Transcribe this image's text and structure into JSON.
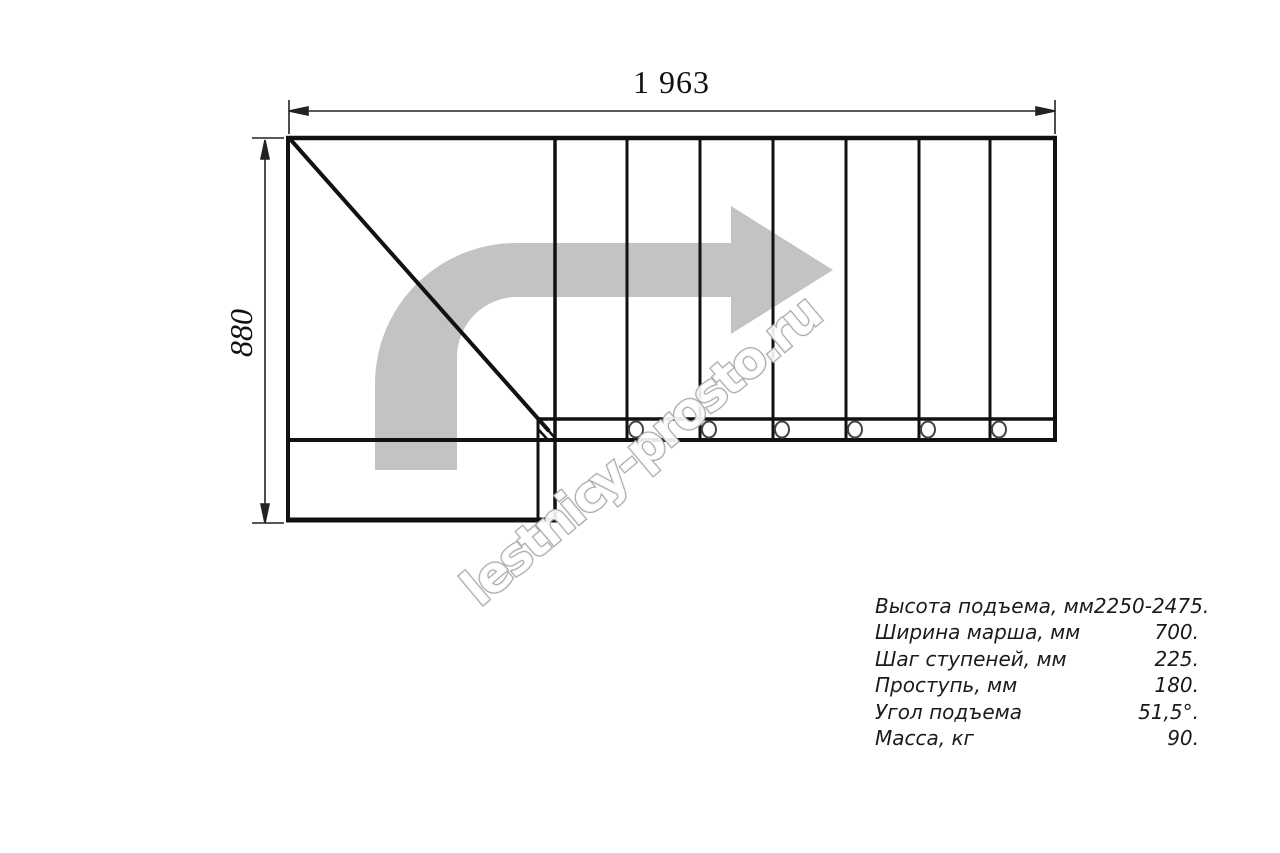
{
  "watermark": {
    "text": "lestnicy-prosto.ru"
  },
  "dimensions": {
    "width_label": "1 963",
    "height_label": "880"
  },
  "plan": {
    "step_lines_x": [
      627,
      700,
      773,
      846,
      919,
      990
    ],
    "bolt_circles_x": [
      636,
      709,
      782,
      855,
      928,
      999
    ],
    "colors": {
      "line": "#111111",
      "dim_line": "#222222",
      "arrow_fill": "#c3c3c3",
      "watermark_outline": "#acacac",
      "watermark_fill": "rgba(255,255,255,0.9)",
      "text": "#1b1b1b"
    }
  },
  "specs": {
    "rows": [
      {
        "label": "Высота подъема, мм",
        "value": "2250-2475."
      },
      {
        "label": "Ширина марша, мм",
        "value": "700."
      },
      {
        "label": "Шаг ступеней, мм",
        "value": "225."
      },
      {
        "label": "Проступь, мм",
        "value": "180."
      },
      {
        "label": "Угол подъема",
        "value": "51,5°."
      },
      {
        "label": "Масса, кг",
        "value": "90."
      }
    ]
  }
}
